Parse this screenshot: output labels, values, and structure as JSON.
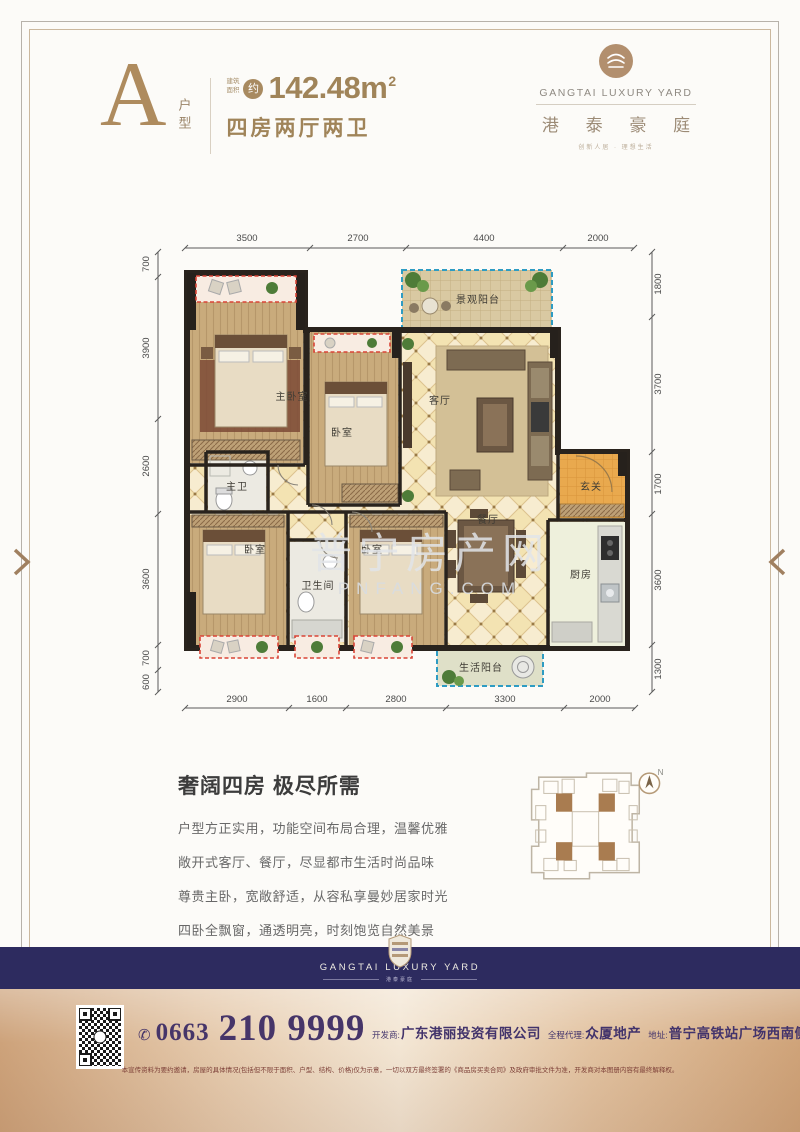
{
  "header": {
    "unit_letter": "A",
    "unit_label": "户型",
    "area_prefix": "建筑面积",
    "area_approx": "约",
    "area_value": "142.48m",
    "area_sup": "2",
    "layout_label": "四房两厅两卫"
  },
  "brand": {
    "name_en": "GANGTAI LUXURY YARD",
    "name_cn": "港 泰 豪 庭",
    "tagline": "创新人居 · 理想生活"
  },
  "floorplan": {
    "dims_top": [
      "3500",
      "2700",
      "4400",
      "2000"
    ],
    "dims_left": [
      "700",
      "3900",
      "2600",
      "3600",
      "700",
      "600"
    ],
    "dims_right": [
      "1800",
      "3700",
      "1700",
      "3600",
      "1300"
    ],
    "dims_bottom": [
      "2900",
      "1600",
      "2800",
      "3300",
      "2000"
    ],
    "rooms": {
      "master_bedroom": "主卧室",
      "bedroom_top": "卧室",
      "master_bath": "主卫",
      "living": "客厅",
      "view_balcony": "景观阳台",
      "foyer": "玄关",
      "dining": "餐厅",
      "kitchen": "厨房",
      "bathroom": "卫生间",
      "bedroom_left": "卧室",
      "bedroom_mid": "卧室",
      "life_balcony": "生活阳台"
    },
    "watermark_cn": "普宁房产网",
    "watermark_en": "PNFANG.COM"
  },
  "description": {
    "title": "奢阔四房 极尽所需",
    "lines": [
      "户型方正实用，功能空间布局合理，温馨优雅",
      "敞开式客厅、餐厅，尽显都市生活时尚品味",
      "尊贵主卧，宽敞舒适，从容私享曼妙居家时光",
      "四卧全飘窗，通透明亮，时刻饱览自然美景"
    ]
  },
  "siteplan": {
    "compass_label": "N"
  },
  "footer_band": {
    "logo_en": "GANGTAI LUXURY YARD",
    "logo_sub": "港泰豪庭"
  },
  "contact": {
    "phone_icon": "✆",
    "phone_area": "0663",
    "phone_number": "210 9999",
    "developer_label": "开发商:",
    "developer": "广东港丽投资有限公司",
    "agent_label": "全程代理:",
    "agent": "众厦地产",
    "address_label": "地址:",
    "address": "普宁高铁站广场西南侧",
    "disclaimer": "本宣传资料为要约邀请，房屋的具体情况(包括但不限于面积、户型、结构、价格)仅为示意，一切以双方最终签署的《商品房买卖合同》及政府审批文件为准，开发商对本图册内容有最终解释权。"
  },
  "colors": {
    "brand_tan": "#ae8b5e",
    "navy": "#2d2b5f",
    "phone_purple": "#463569",
    "bay_red": "#d94436",
    "balcony_blue": "#2e9cc3"
  }
}
